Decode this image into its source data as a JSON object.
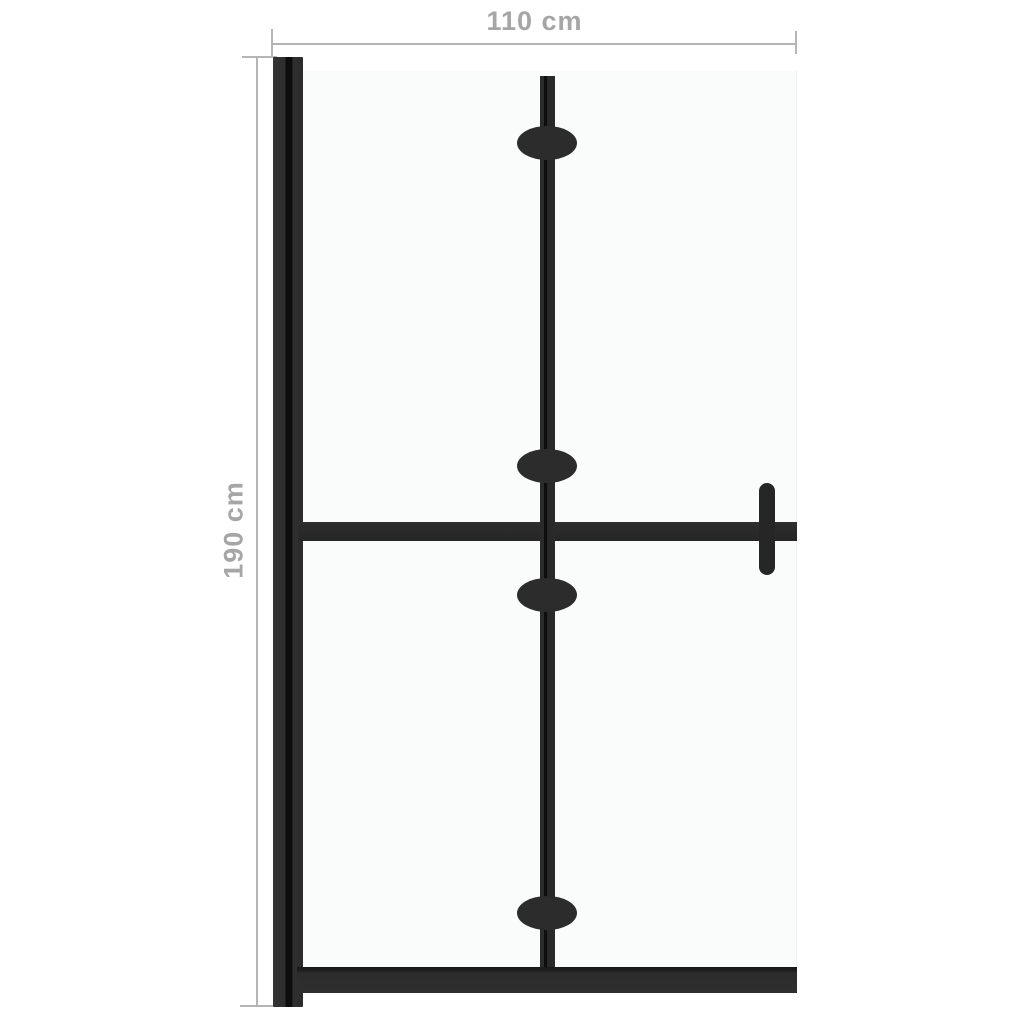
{
  "diagram": {
    "type": "product-dimension-diagram",
    "dimensions": {
      "width_label": "110 cm",
      "height_label": "190 cm"
    },
    "parts": {
      "wall_profile": "left mounting wall profile",
      "glass_panel": "glass screen panel",
      "fold_line": "central fold line",
      "hinge_count": 4,
      "crossbar_middle": "horizontal middle support bar",
      "bottom_rail": "bottom rail",
      "handle": "right side handle"
    }
  },
  "colors": {
    "background": "#ffffff",
    "frame": "#2c2c2c",
    "frame_dark": "#0d0d0d",
    "glass": "#fafcfb",
    "dimension_line": "#b5b5b5",
    "dimension_text": "#a6a6a6"
  }
}
